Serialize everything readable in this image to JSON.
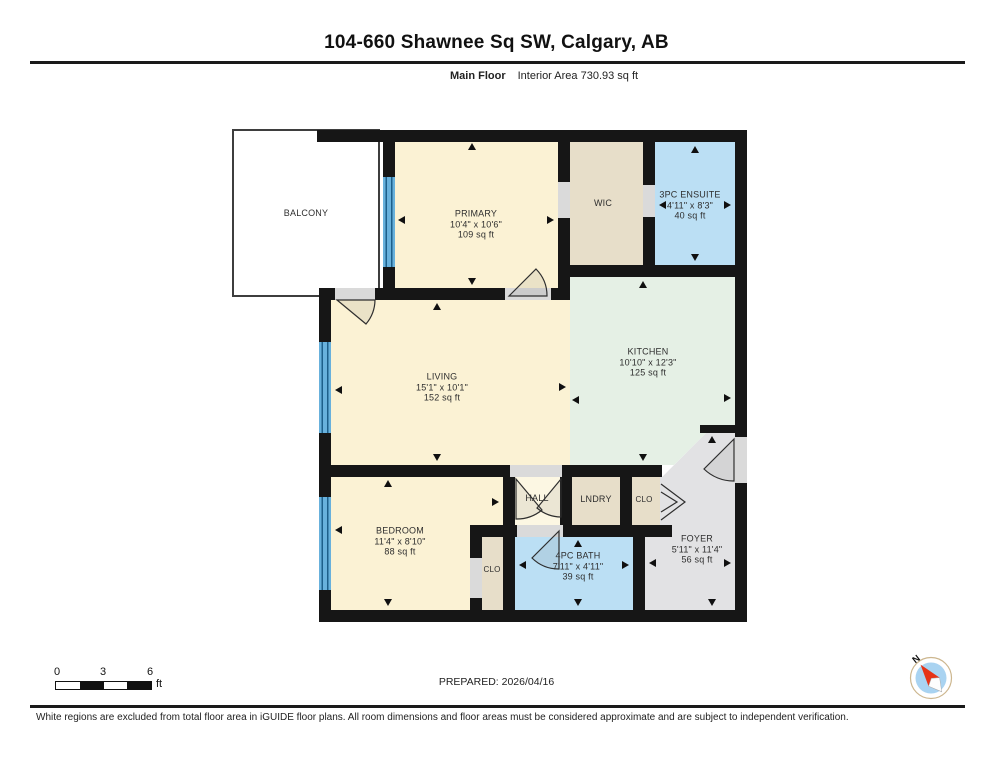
{
  "header": {
    "title": "104-660 Shawnee Sq SW, Calgary, AB",
    "floor_label": "Main Floor",
    "interior_area": "Interior Area 730.93 sq ft"
  },
  "plan": {
    "colors": {
      "wall": "#161616",
      "cream": "#FBF2D4",
      "hall_cream": "#FCF7E3",
      "tan": "#E7DEC9",
      "blue": "#BBDFF4",
      "mint": "#E5F0E5",
      "grey": "#E2E2E4",
      "opening": "#DADADA",
      "window_light": "#68B1DC",
      "window_dark": "#1D5F8A",
      "compass_red": "#E63317",
      "compass_blue": "#A9D3F1"
    },
    "rooms": {
      "balcony": {
        "name": "BALCONY"
      },
      "primary": {
        "name": "PRIMARY",
        "dims": "10'4\" x 10'6\"",
        "area": "109 sq ft"
      },
      "wic": {
        "name": "WIC"
      },
      "ensuite": {
        "name": "3PC ENSUITE",
        "dims": "4'11\" x 8'3\"",
        "area": "40 sq ft"
      },
      "kitchen": {
        "name": "KITCHEN",
        "dims": "10'10\" x 12'3\"",
        "area": "125 sq ft"
      },
      "living": {
        "name": "LIVING",
        "dims": "15'1\" x 10'1\"",
        "area": "152 sq ft"
      },
      "bedroom": {
        "name": "BEDROOM",
        "dims": "11'4\" x 8'10\"",
        "area": "88 sq ft"
      },
      "bedroom_closet": {
        "name": "CLO"
      },
      "hall": {
        "name": "HALL"
      },
      "laundry": {
        "name": "LNDRY"
      },
      "foyer_closet": {
        "name": "CLO"
      },
      "bath": {
        "name": "4PC BATH",
        "dims": "7'11\" x 4'11\"",
        "area": "39 sq ft"
      },
      "foyer": {
        "name": "FOYER",
        "dims": "5'11\" x 11'4\"",
        "area": "56 sq ft"
      }
    }
  },
  "scale_bar": {
    "labels": [
      "0",
      "3",
      "6"
    ],
    "unit": "ft"
  },
  "footer": {
    "prepared": "PREPARED: 2026/04/16",
    "compass_label": "N",
    "disclaimer": "White regions are excluded from total floor area in iGUIDE floor plans. All room dimensions and floor areas must be considered approximate and are subject to independent verification."
  }
}
